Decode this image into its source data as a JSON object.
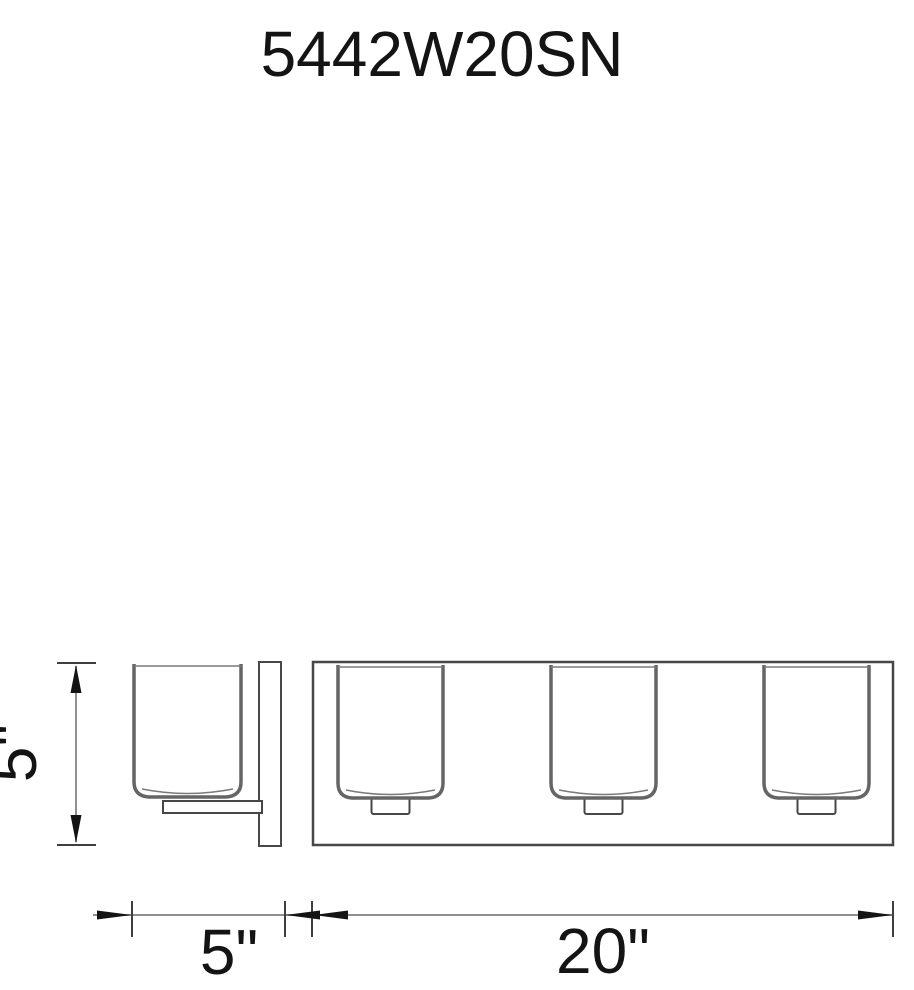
{
  "drawing": {
    "title": "5442W20SN",
    "dimensions": {
      "height_label": "5\"",
      "depth_label": "5\"",
      "width_label": "20\""
    },
    "front_view": {
      "shade_count": 3
    },
    "colors": {
      "background": "#ffffff",
      "outline": "#474747",
      "shade_stroke": "#656565",
      "dimension_line": "#8f8f8f",
      "arrow_and_text": "#141414"
    }
  }
}
